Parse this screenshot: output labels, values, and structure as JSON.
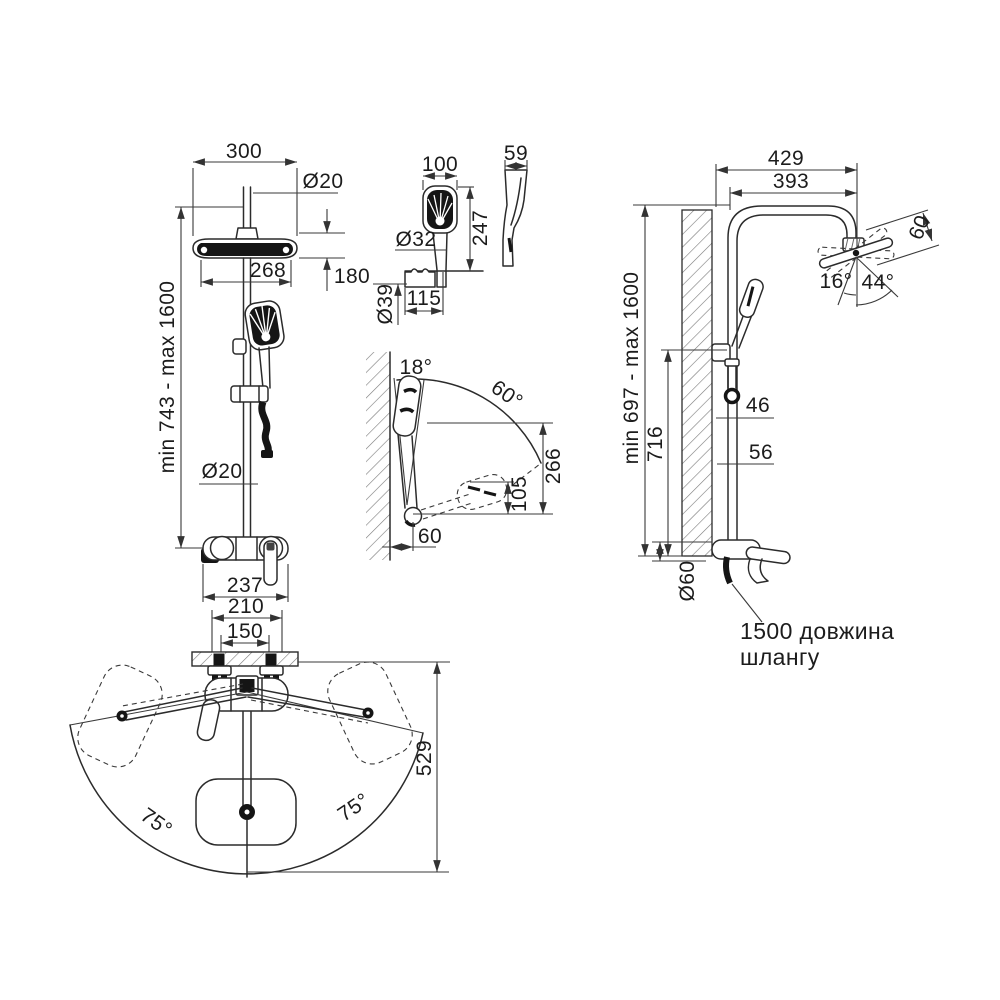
{
  "drawing": {
    "front_view": {
      "w300": "300",
      "dia20_top": "Ø20",
      "w268": "268",
      "h180": "180",
      "range": "min 743 - max 1600",
      "dia20_mid": "Ø20",
      "w237": "237"
    },
    "hand_shower_view": {
      "w100": "100",
      "d59": "59",
      "l247": "247",
      "dia32": "Ø32",
      "dia39": "Ø39",
      "off115": "115"
    },
    "angle_view": {
      "a18": "18°",
      "a60": "60°",
      "r266": "266",
      "r105": "105",
      "off60": "60"
    },
    "side_view": {
      "w429": "429",
      "w393": "393",
      "t60": "60",
      "a16": "16°",
      "a44": "44°",
      "range": "min 697 - max 1600",
      "h716": "716",
      "o46": "46",
      "o56": "56",
      "dia60": "Ø60",
      "hose_note_line1": "1500 довжина",
      "hose_note_line2": "шлангу"
    },
    "top_view": {
      "w210": "210",
      "w150": "150",
      "r529": "529",
      "swing_left": "75°",
      "swing_right": "75°"
    }
  }
}
